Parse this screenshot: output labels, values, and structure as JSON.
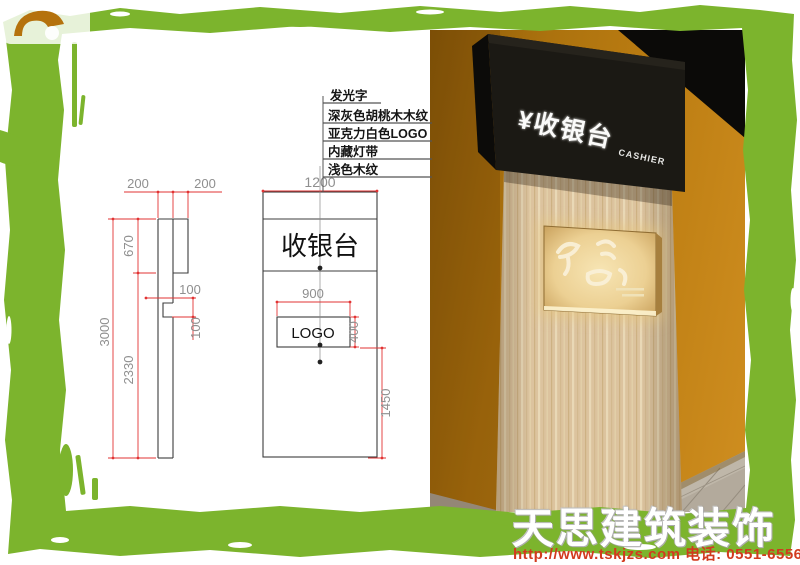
{
  "drawing": {
    "callout_top": "发光字",
    "callouts": [
      "深灰色胡桃木木纹",
      "亚克力白色LOGO",
      "内藏灯带",
      "浅色木纹"
    ],
    "front_view": {
      "sign_text": "收银台",
      "logo_text": "LOGO",
      "dims": {
        "width": "1200",
        "logo_width": "900",
        "logo_height": "400",
        "logo_offset_bottom": "1450"
      }
    },
    "side_view": {
      "dims": {
        "top_a": "200",
        "top_b": "200",
        "header": "670",
        "body": "2330",
        "total": "3000",
        "notch_a": "100",
        "notch_b": "100"
      }
    },
    "colors": {
      "dim_line": "#e23333",
      "outline": "#3c3c3c",
      "dim_text": "#8f8f8f"
    }
  },
  "render": {
    "header_text": "¥收银台",
    "header_sub": "CASHIER",
    "logo_mark": "stylized-calligraphy-logo",
    "colors": {
      "wall": "#b5780f",
      "header_box": "#17150f",
      "wood": "#dcc49e",
      "lightbox_glow": "#f3dca6"
    }
  },
  "watermark": {
    "company": "天思建筑装饰",
    "contact": "http://www.tskjzs.com 电话: 0551-65568226"
  },
  "frame": {
    "color": "#7cb42d"
  }
}
